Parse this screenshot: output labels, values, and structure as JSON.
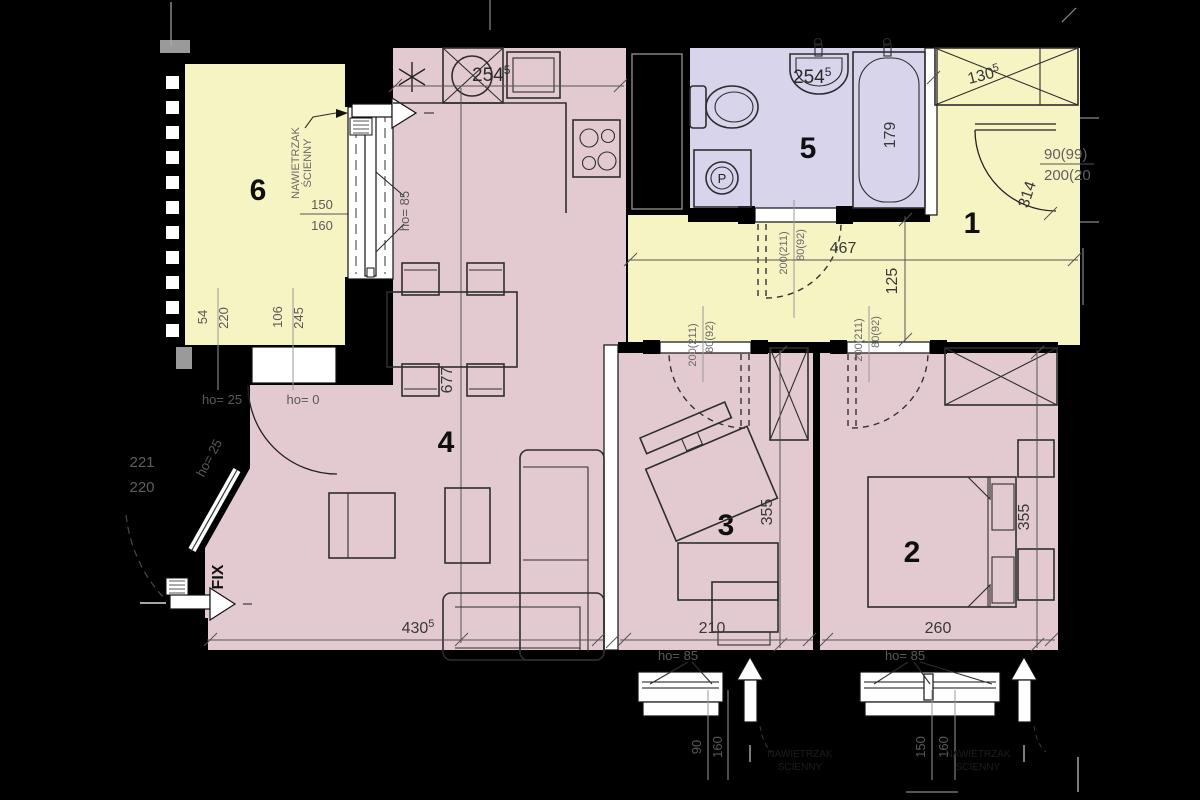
{
  "colors": {
    "yellow": "#f7f4c3",
    "pink": "#e3cad0",
    "lavender": "#d7d4ec",
    "wall": "#000000"
  },
  "rooms": {
    "r1": "1",
    "r2": "2",
    "r3": "3",
    "r4": "4",
    "r5": "5",
    "r6": "6"
  },
  "balcony": {
    "vent1": "NAWIETRZAK",
    "vent2": "ŚCIENNY",
    "win_w": "150",
    "win_o": "160",
    "d1a": "54",
    "d1b": "220",
    "d2a": "106",
    "d2b": "245"
  },
  "kitchen": {
    "dim": "254",
    "dim_sup": "5",
    "win_ho": "ho= 85"
  },
  "bath": {
    "dim": "254",
    "dim_sup": "5",
    "tub_len": "179",
    "door_h": "200(211)",
    "door_w": "80(92)",
    "washer": "P"
  },
  "hall": {
    "wardrobe": "130",
    "wardrobe_sup": "5",
    "entry_w": "90(99)",
    "entry_h": "200(20",
    "door_arc": "314",
    "width": "467",
    "depth": "125"
  },
  "living": {
    "len": "677",
    "width": "430",
    "width_sup": "5",
    "ho25": "ho= 25",
    "ho0": "ho= 0",
    "fix": "FIX",
    "fix_ho": "ho= 25",
    "out_a": "221",
    "out_b": "220"
  },
  "bed3": {
    "depth": "355",
    "width": "210",
    "door_h": "200(211)",
    "door_w": "80(92)",
    "win_ho": "ho= 85",
    "win_w": "90",
    "win_o": "160",
    "vent1": "NAWIETRZAK",
    "vent2": "ŚCIENNY"
  },
  "bed2": {
    "depth": "355",
    "width": "260",
    "door_h": "200(211)",
    "door_w": "80(92)",
    "win_ho": "ho= 85",
    "win_w": "150",
    "win_o": "160",
    "vent1": "NAWIETRZAK",
    "vent2": "ŚCIENNY"
  }
}
